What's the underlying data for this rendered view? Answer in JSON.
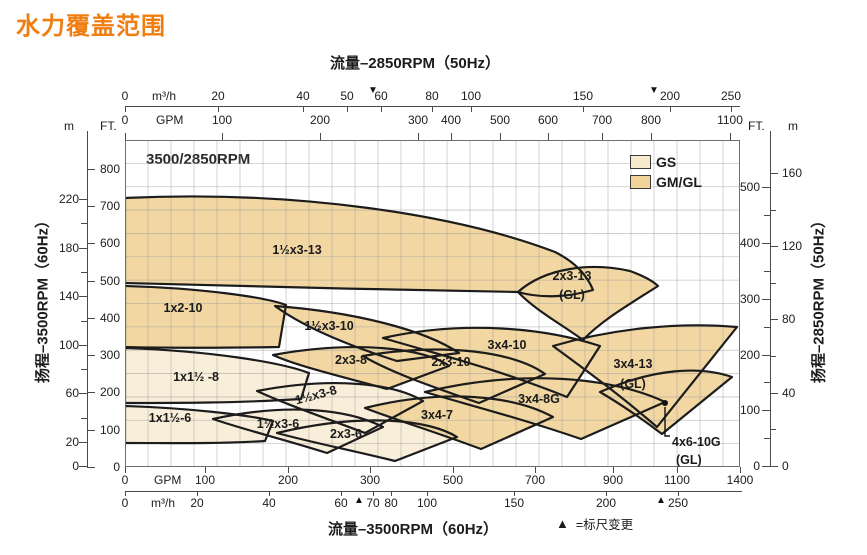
{
  "title": "水力覆盖范围",
  "rpm_label": "3500/2850RPM",
  "footnote": {
    "symbol": "▲",
    "text": "=标尺变更"
  },
  "colors": {
    "title_orange": "#f07d10",
    "gs_fill": "#f8eed9",
    "gmgl_fill": "#f2d7a2",
    "outline": "#1c1c1c",
    "grid": "#9b9b9b",
    "axis": "#4a4a4a"
  },
  "legend": [
    {
      "label": "GS",
      "color": "#f6e9cc"
    },
    {
      "label": "GM/GL",
      "color": "#f2d49b"
    }
  ],
  "axes": {
    "top": {
      "title": "流量–2850RPM（50Hz）",
      "m3h": {
        "unit": "m³/h",
        "unit_x": 152,
        "line_y": 106,
        "label_y": 90,
        "x0": 125,
        "x1": 740,
        "ticks": [
          [
            "0",
            125
          ],
          [
            "20",
            218
          ],
          [
            "40",
            303
          ],
          [
            "50",
            347
          ],
          [
            "60",
            381
          ],
          [
            "80",
            432
          ],
          [
            "100",
            471
          ],
          [
            "150",
            583
          ],
          [
            "200",
            670
          ],
          [
            "250",
            731
          ]
        ],
        "markers": [
          373,
          654
        ],
        "marker_symbol": "▼",
        "marker_y": 86
      },
      "gpm": {
        "unit": "GPM",
        "unit_x": 156,
        "label_y": 114,
        "ticks": [
          [
            "0",
            125
          ],
          [
            "100",
            222
          ],
          [
            "200",
            320
          ],
          [
            "300",
            418
          ],
          [
            "400",
            451
          ],
          [
            "500",
            500
          ],
          [
            "600",
            548
          ],
          [
            "700",
            602
          ],
          [
            "800",
            651
          ],
          [
            "1100",
            730
          ]
        ]
      }
    },
    "bottom": {
      "title": "流量–3500RPM（60Hz）",
      "gpm": {
        "unit": "GPM",
        "unit_x": 154,
        "label_y": 474,
        "ticks": [
          [
            "0",
            125
          ],
          [
            "100",
            205
          ],
          [
            "200",
            288
          ],
          [
            "300",
            370
          ],
          [
            "500",
            453
          ],
          [
            "700",
            535
          ],
          [
            "900",
            613
          ],
          [
            "1100",
            677
          ],
          [
            "1400",
            740
          ]
        ]
      },
      "m3h": {
        "unit": "m³/h",
        "unit_x": 151,
        "line_y": 491,
        "label_y": 497,
        "x0": 125,
        "x1": 742,
        "ticks": [
          [
            "0",
            125
          ],
          [
            "20",
            197
          ],
          [
            "40",
            269
          ],
          [
            "60",
            341
          ],
          [
            "70",
            373
          ],
          [
            "80",
            391
          ],
          [
            "100",
            427
          ],
          [
            "150",
            514
          ],
          [
            "200",
            606
          ],
          [
            "250",
            678
          ]
        ],
        "markers": [
          359,
          661
        ],
        "marker_symbol": "▲",
        "marker_y": 496
      }
    },
    "left": {
      "label": "扬程–3500RPM（60Hz）",
      "label_x": 42,
      "label_y": 298,
      "line_x": 87,
      "line_y0": 131,
      "line_y1": 467,
      "m_header": "m",
      "m_header_x": 64,
      "ft_header": "FT.",
      "ft_header_x": 100,
      "header_y": 120,
      "m_ticks": [
        [
          "220",
          199
        ],
        [
          "180",
          248
        ],
        [
          "140",
          296
        ],
        [
          "100",
          345
        ],
        [
          "60",
          393
        ],
        [
          "20",
          442
        ],
        [
          "0",
          466
        ]
      ],
      "m_minor": [
        223,
        272,
        321,
        369,
        418
      ],
      "ft_ticks": [
        [
          "800",
          169
        ],
        [
          "700",
          206
        ],
        [
          "600",
          243
        ],
        [
          "500",
          281
        ],
        [
          "400",
          318
        ],
        [
          "300",
          355
        ],
        [
          "200",
          392
        ],
        [
          "100",
          430
        ],
        [
          "0",
          467
        ]
      ]
    },
    "right": {
      "label": "扬程–2850RPM（50Hz）",
      "label_x": 818,
      "label_y": 298,
      "line_x": 770,
      "line_y0": 131,
      "line_y1": 466,
      "ft_header": "FT.",
      "ft_header_x": 748,
      "m_header": "m",
      "m_header_x": 788,
      "header_y": 120,
      "ft_ticks": [
        [
          "500",
          187
        ],
        [
          "400",
          243
        ],
        [
          "300",
          299
        ],
        [
          "200",
          355
        ],
        [
          "100",
          410
        ],
        [
          "0",
          466
        ]
      ],
      "ft_minor": [
        215,
        271,
        327,
        382,
        438
      ],
      "m_ticks": [
        [
          "160",
          173
        ],
        [
          "120",
          246
        ],
        [
          "80",
          319
        ],
        [
          "40",
          393
        ],
        [
          "0",
          466
        ]
      ],
      "m_minor": [
        210,
        283,
        356,
        429
      ]
    }
  },
  "chart_data": {
    "type": "coverage-envelope",
    "title": "3500/2850RPM pump hydraulic coverage",
    "x_axis": {
      "bottom": "Flow, 3500RPM 60Hz (GPM / m³/h)",
      "top": "Flow, 2850RPM 50Hz (GPM / m³/h)"
    },
    "y_axis": {
      "left": "Head, 3500RPM 60Hz (FT / m)",
      "right": "Head, 2850RPM 50Hz (FT / m)"
    },
    "scale_note": "▲/▼ = scale change points on flow axes",
    "plot": {
      "x": 125,
      "y": 140,
      "w": 615,
      "h": 327,
      "grid_step_x": 23,
      "grid_step_y": 23.357
    },
    "envelopes": [
      {
        "label": "1½x3-13",
        "series": "GM/GL",
        "flow_gpm_60hz": [
          0,
          850
        ],
        "head_ft_60hz": [
          455,
          720
        ],
        "lx": 172,
        "ly": 114,
        "path": "M0,58 C170,50 330,74 430,112 C450,122 462,135 468,150 C440,158 414,158 393,152 C270,150 110,146 0,143 Z"
      },
      {
        "label": "2x3-13",
        "sub": "(GL)",
        "series": "GM/GL",
        "flow_gpm_60hz": [
          660,
          1070
        ],
        "head_ft_60hz": [
          340,
          550
        ],
        "lx": 447,
        "ly": 140,
        "sy": 159,
        "path": "M393,152 C420,128 465,122 505,131 C516,135 527,140 533,146 C505,164 477,180 458,200 C436,184 410,170 393,152 Z"
      },
      {
        "label": "1x2-10",
        "series": "GM/GL",
        "flow_gpm_60hz": [
          0,
          200
        ],
        "head_ft_60hz": [
          320,
          485
        ],
        "lx": 58,
        "ly": 172,
        "path": "M0,146 C75,148 140,157 161,165 L154,207 C100,208 45,208 0,207 Z"
      },
      {
        "label": "1½x3-10",
        "series": "GM/GL",
        "flow_gpm_60hz": [
          185,
          520
        ],
        "head_ft_60hz": [
          285,
          430
        ],
        "lx": 204,
        "ly": 190,
        "path": "M150,166 C230,172 300,190 334,213 L272,221 C225,206 180,188 150,166 Z"
      },
      {
        "label": "3x4-10",
        "series": "GM/GL",
        "flow_gpm_60hz": [
          315,
          865
        ],
        "head_ft_60hz": [
          190,
          395
        ],
        "lx": 382,
        "ly": 209,
        "path": "M258,198 C340,180 420,188 475,206 L442,257 C370,228 305,212 258,198 Z"
      },
      {
        "label": "2x3-10",
        "series": "GM/GL",
        "flow_gpm_60hz": [
          290,
          730
        ],
        "head_ft_60hz": [
          170,
          335
        ],
        "lx": 326,
        "ly": 226,
        "path": "M238,216 C320,202 390,212 420,234 L354,263 C305,246 265,232 238,216 Z"
      },
      {
        "label": "2x3-8",
        "series": "GM/GL",
        "flow_gpm_60hz": [
          180,
          495
        ],
        "head_ft_60hz": [
          210,
          340
        ],
        "lx": 226,
        "ly": 224,
        "path": "M148,215 C230,200 300,208 324,226 L262,249 C215,236 172,226 148,215 Z"
      },
      {
        "label": "3x4-13",
        "sub": "(GL)",
        "series": "GM/GL",
        "flow_gpm_60hz": [
          750,
          1390
        ],
        "head_ft_60hz": [
          105,
          390
        ],
        "lx": 508,
        "ly": 228,
        "sy": 248,
        "path": "M428,206 C490,188 555,182 612,187 L532,287 C495,255 458,228 428,206 Z"
      },
      {
        "label": "1x1½ -8",
        "series": "GS",
        "flow_gpm_60hz": [
          0,
          225
        ],
        "head_ft_60hz": [
          170,
          320
        ],
        "lx": 71,
        "ly": 241,
        "path": "M0,208 C85,211 155,222 184,233 L176,259 C115,263 50,263 0,263 Z"
      },
      {
        "label": "1½x3-8",
        "series": "GS",
        "flow_gpm_60hz": [
          160,
          430
        ],
        "head_ft_60hz": [
          90,
          245
        ],
        "lx": 192,
        "ly": 259,
        "rot": -15,
        "path": "M132,251 C210,236 270,244 298,261 L240,293 C192,275 158,263 132,251 Z"
      },
      {
        "label": "1x1½-6",
        "series": "GS",
        "flow_gpm_60hz": [
          0,
          180
        ],
        "head_ft_60hz": [
          65,
          165
        ],
        "lx": 45,
        "ly": 282,
        "path": "M0,266 C60,268 118,274 148,281 L140,301 C92,304 42,303 0,303 Z"
      },
      {
        "label": "1½x3-6",
        "series": "GS",
        "flow_gpm_60hz": [
          110,
          330
        ],
        "head_ft_60hz": [
          40,
          175
        ],
        "lx": 153,
        "ly": 288,
        "path": "M88,279 C165,262 225,270 258,287 L202,313 C158,299 120,290 88,279 Z"
      },
      {
        "label": "2x3-6",
        "series": "GS",
        "flow_gpm_60hz": [
          185,
          515
        ],
        "head_ft_60hz": [
          15,
          150
        ],
        "lx": 221,
        "ly": 298,
        "path": "M152,293 C240,272 305,280 332,297 L270,321 C225,310 185,302 152,293 Z"
      },
      {
        "label": "3x4-8G",
        "series": "GM/GL",
        "flow_gpm_60hz": [
          435,
          1100
        ],
        "head_ft_60hz": [
          75,
          265
        ],
        "lx": 414,
        "ly": 263,
        "path": "M300,252 C400,228 490,238 540,262 L456,299 C395,278 340,264 300,252 Z"
      },
      {
        "label": "3x4-7",
        "series": "GM/GL",
        "flow_gpm_60hz": [
          295,
          750
        ],
        "head_ft_60hz": [
          50,
          210
        ],
        "lx": 312,
        "ly": 279,
        "path": "M240,268 C320,248 390,256 428,277 L356,309 C305,290 265,278 240,268 Z"
      },
      {
        "label": "4x6-10G",
        "sub": "(GL)",
        "series": "GM/GL",
        "flow_gpm_60hz": [
          865,
          1390
        ],
        "head_ft_60hz": [
          90,
          270
        ],
        "lx": 547,
        "ly": 306,
        "sy": 324,
        "anchor": "start",
        "dot": [
          540,
          263
        ],
        "leader": "M540,267 L540,296 L545,296",
        "path": "M475,252 C530,228 575,226 607,237 L537,294 C512,275 492,262 475,252 Z"
      }
    ]
  }
}
